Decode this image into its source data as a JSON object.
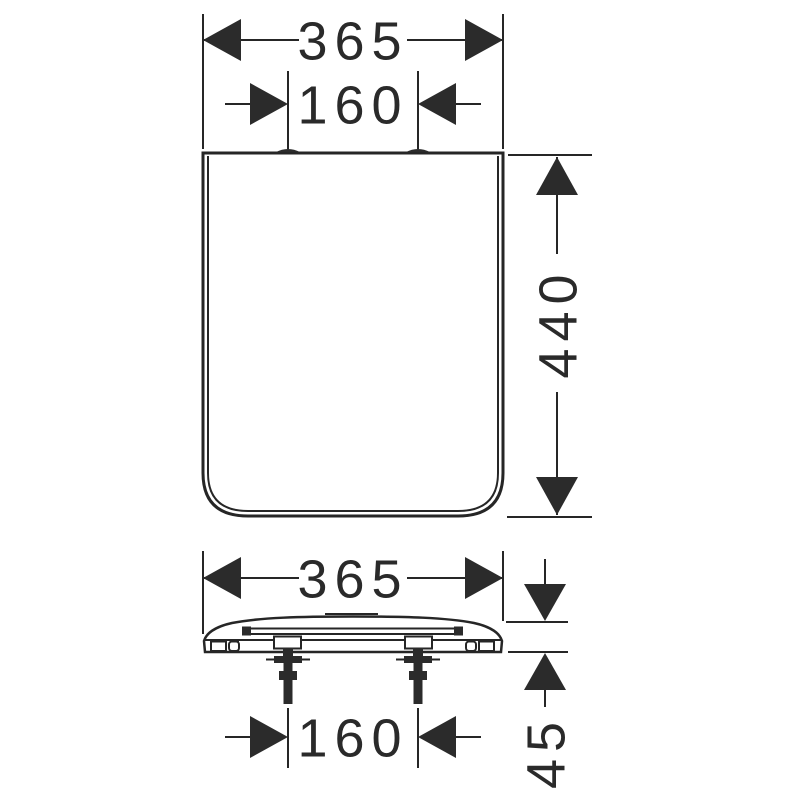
{
  "colors": {
    "line": "#262626",
    "text": "#2a2a2a",
    "background": "#ffffff"
  },
  "drawing": {
    "type": "technical-dimension-drawing",
    "subject": "toilet seat with lid, plan view and front elevation",
    "dimensions": {
      "plan_width": "365",
      "plan_hinge_spacing": "160",
      "plan_depth": "440",
      "front_width": "365",
      "front_hinge_spacing": "160",
      "front_height": "45"
    }
  }
}
